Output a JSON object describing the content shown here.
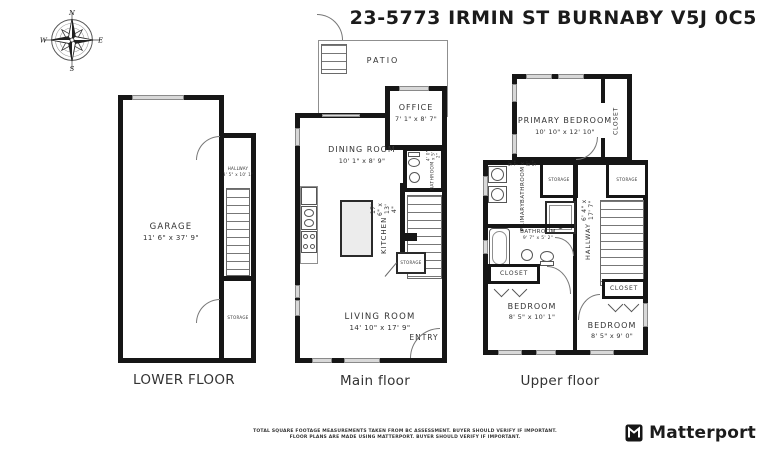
{
  "title": "23-5773 IRMIN ST BURNABY V5J 0C5",
  "compass": {
    "n": "N",
    "e": "E",
    "s": "S",
    "w": "W"
  },
  "lower": {
    "label": "LOWER FLOOR",
    "garage_name": "GARAGE",
    "garage_dims": "11' 6\" x 37' 9\"",
    "hallway_name": "HALLWAY",
    "hallway_dims": "3' 5\" x 10' 1\"",
    "storage_label": "STORAGE"
  },
  "main": {
    "label": "Main floor",
    "patio": "PATIO",
    "office_name": "OFFICE",
    "office_dims": "7' 1\" x 8' 7\"",
    "dining_name": "DINING ROOM",
    "dining_dims": "10' 1\" x 8' 9\"",
    "bathroom_name": "BATHROOM",
    "bathroom_dims": "4' 0\" x 5' 2\"",
    "kitchen_name": "KITCHEN",
    "kitchen_dims": "17' 6\" x 13' 4\"",
    "storage_label": "STORAGE",
    "living_name": "LIVING ROOM",
    "living_dims": "14' 10\" x 17' 9\"",
    "entry": "ENTRY"
  },
  "upper": {
    "label": "Upper floor",
    "primary_bedroom_name": "PRIMARY BEDROOM",
    "primary_bedroom_dims": "10' 10\" x 12' 10\"",
    "closet_top": "CLOSET",
    "primary_bath_line1": "PRIMARY",
    "primary_bath_line2": "BATHROOM",
    "primary_bath_dims": "9' 7\" x 8' 5\"",
    "storage_left": "STORAGE",
    "storage_right": "STORAGE",
    "bathroom_name": "BATHROOM",
    "bathroom_dims": "9' 7\" x 5' 2\"",
    "hallway_name": "HALLWAY",
    "hallway_dims": "6' 4\" x 17' 7\"",
    "closet_left": "CLOSET",
    "closet_right": "CLOSET",
    "bedroom_left_name": "BEDROOM",
    "bedroom_left_dims": "8' 5\" x 10' 1\"",
    "bedroom_right_name": "BEDROOM",
    "bedroom_right_dims": "8' 5\" x 9' 0\""
  },
  "footer": {
    "line1": "TOTAL SQUARE FOOTAGE MEASUREMENTS TAKEN FROM BC ASSESSMENT. BUYER SHOULD VERIFY IF IMPORTANT.",
    "line2": "FLOOR PLANS ARE MADE USING MATTERPORT. BUYER SHOULD VERIFY IF IMPORTANT.",
    "brand": "Matterport"
  },
  "colors": {
    "wall": "#161616",
    "window": "#d8d8d8",
    "text": "#333333"
  }
}
